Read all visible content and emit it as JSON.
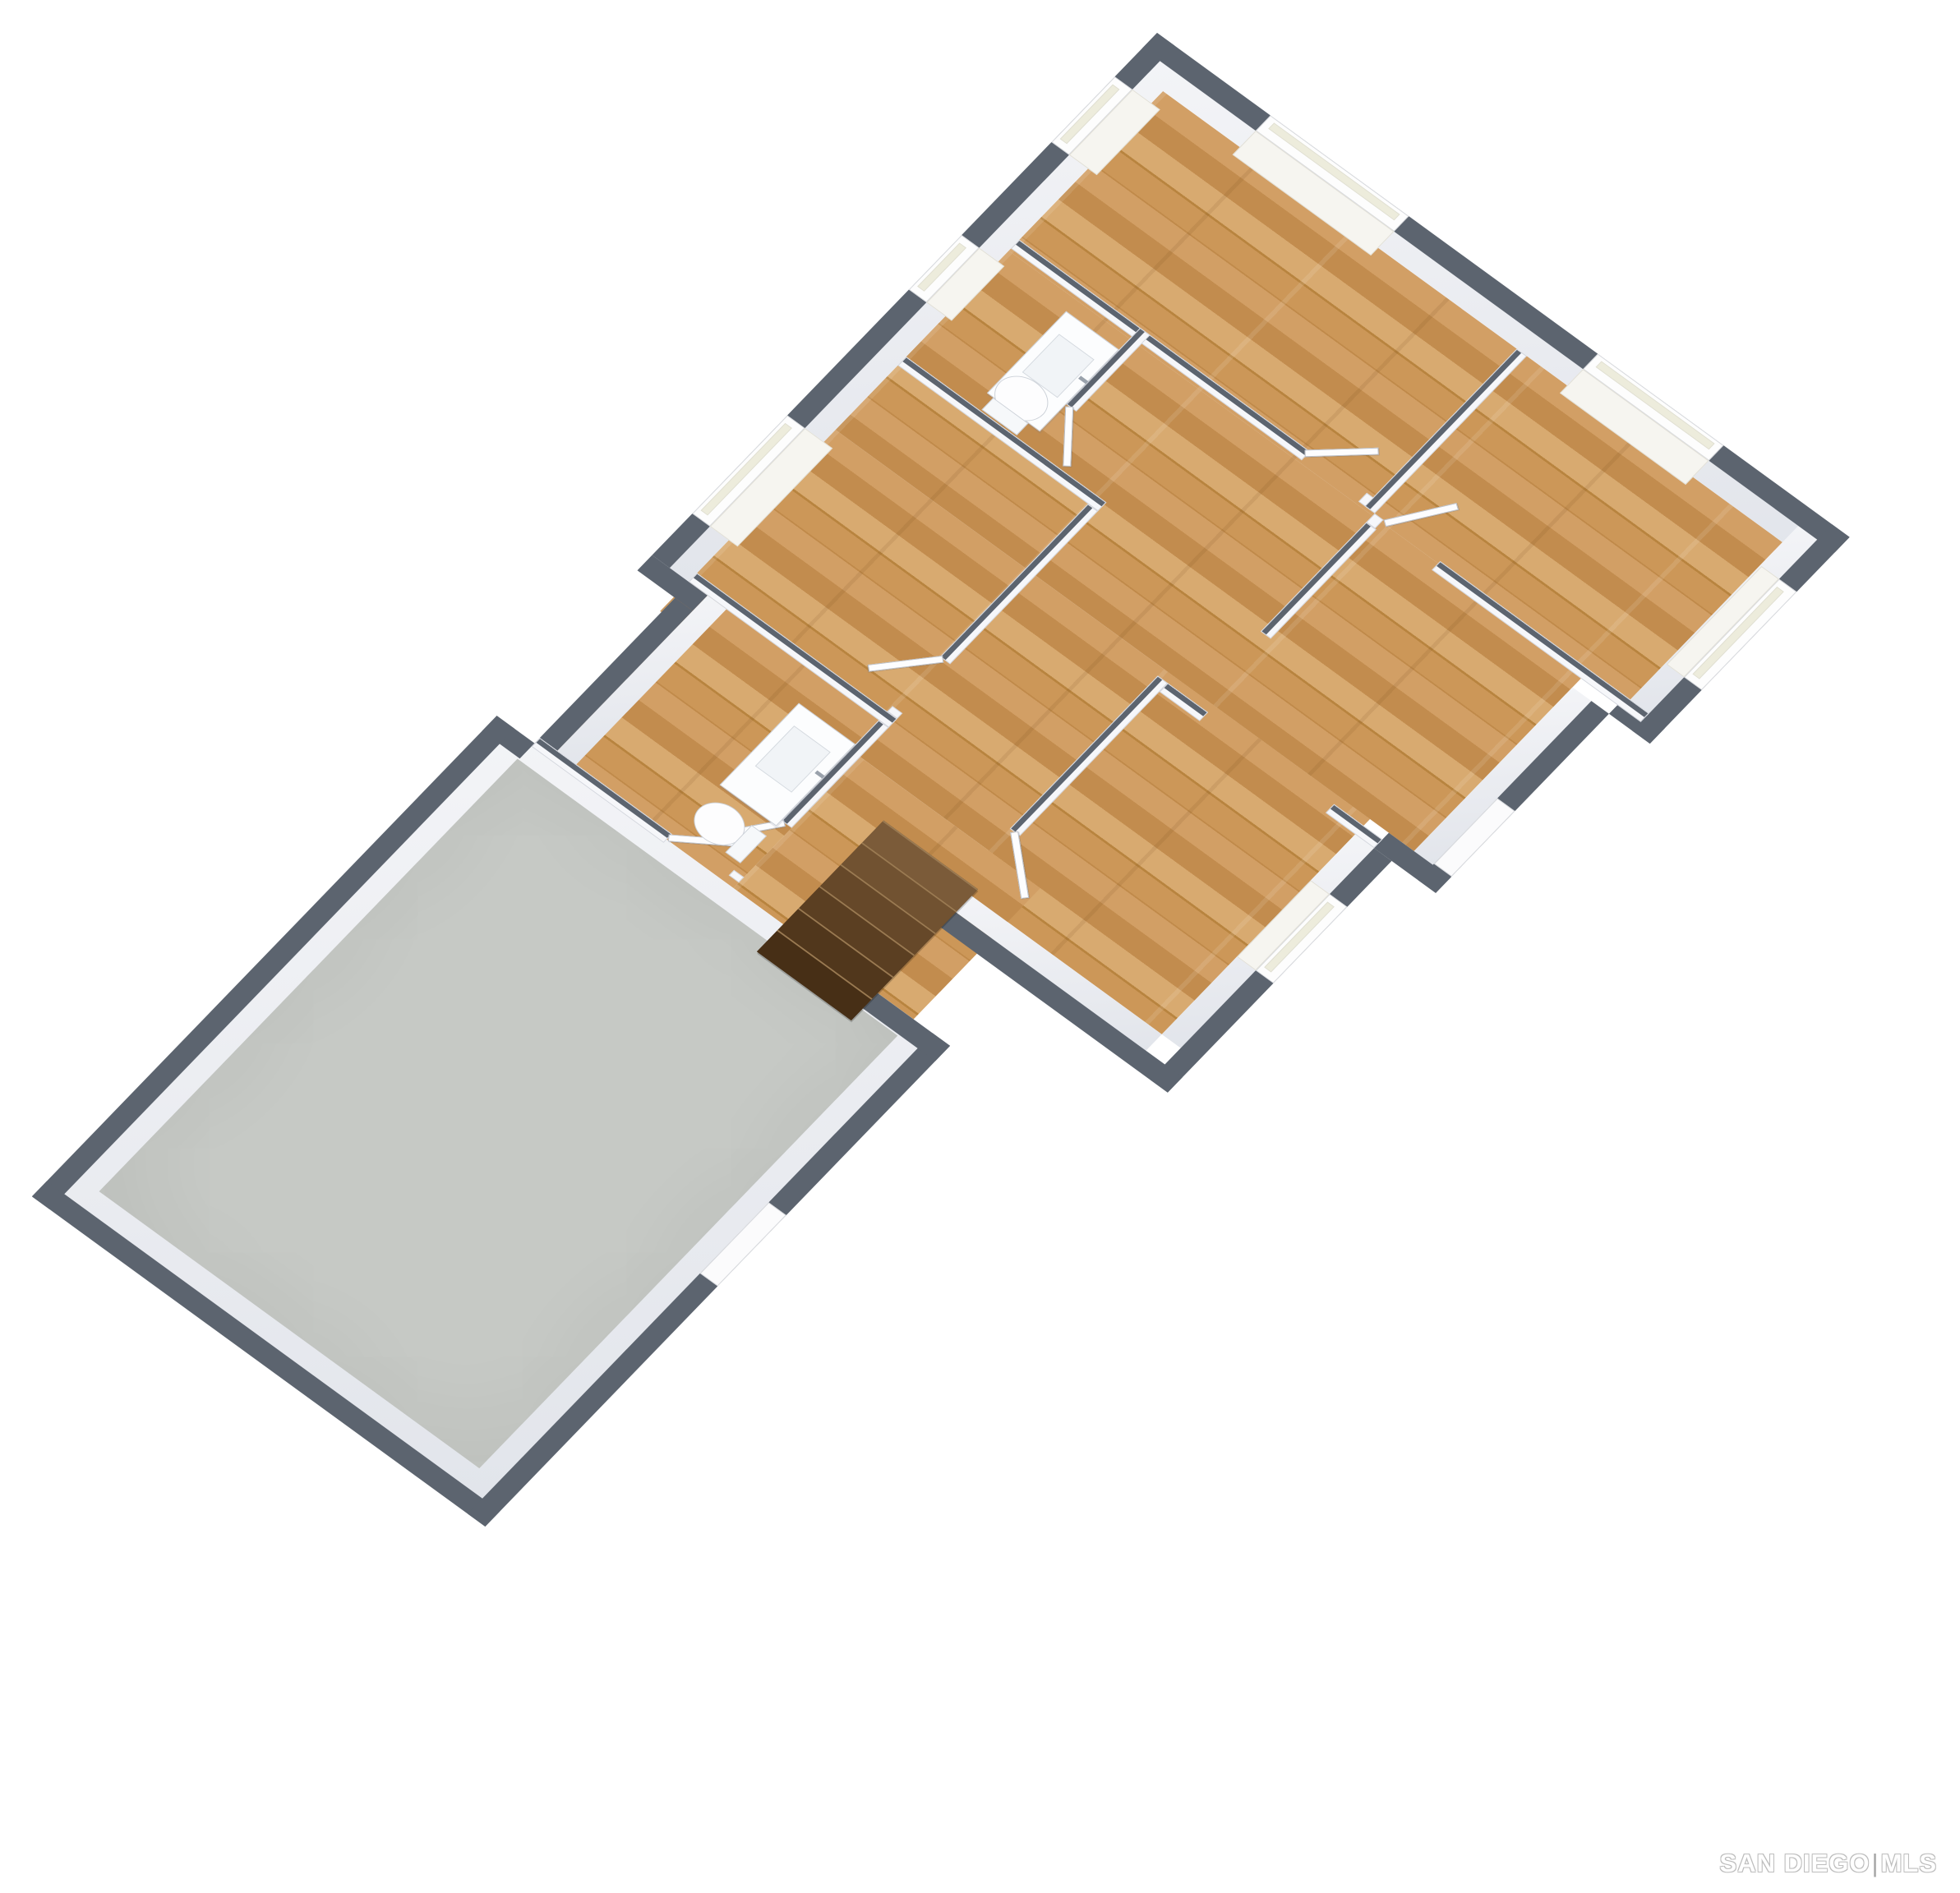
{
  "watermark": {
    "text_primary": "SAN DIEGO",
    "separator": "|",
    "text_secondary": "MLS"
  },
  "view": {
    "kind": "3d-dollhouse-floorplan",
    "rotation_deg": 40
  },
  "colors": {
    "background": "#ffffff",
    "exterior_wall_cap": "#5c646f",
    "interior_wall": "#f6f7fa",
    "wall_face": "#eef0f4",
    "wood_floor": "#c9955c",
    "garage_slab": "#c6c9c5",
    "stairs": "#5d4226",
    "watermark_outline": "#bdbdbd"
  },
  "rooms": [
    {
      "name": "bedroom-1",
      "floor": "wood",
      "windows": 2
    },
    {
      "name": "bedroom-2",
      "floor": "wood",
      "windows": 2
    },
    {
      "name": "bedroom-3",
      "floor": "wood",
      "windows": 1
    },
    {
      "name": "bathroom-top",
      "floor": "wood",
      "fixtures": [
        "sink-vanity",
        "toilet"
      ],
      "windows": 1
    },
    {
      "name": "bathroom-lower",
      "floor": "wood",
      "fixtures": [
        "sink-vanity",
        "toilet"
      ]
    },
    {
      "name": "living-room",
      "floor": "wood"
    },
    {
      "name": "family-room",
      "floor": "wood",
      "windows": 1
    },
    {
      "name": "hallway",
      "floor": "wood"
    },
    {
      "name": "garage",
      "floor": "concrete",
      "doors": 1
    }
  ],
  "features": {
    "stairs_steps": 6,
    "door_leaves": 7
  }
}
